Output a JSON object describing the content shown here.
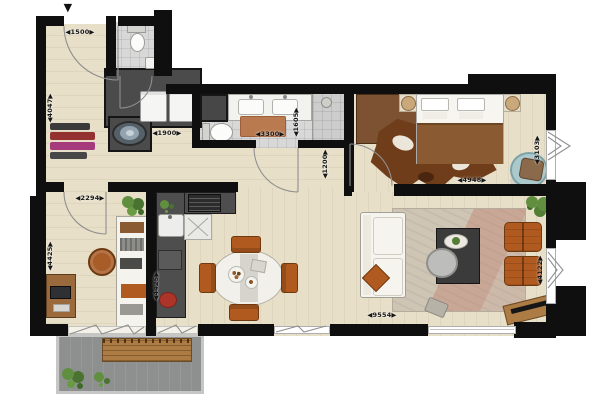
{
  "plan": {
    "title": "apartment-floor-plan",
    "entrance_marker": "▼",
    "dimensions": {
      "entry_width": "◀1500▶",
      "hall_depth": "◀4047▶",
      "utility_width": "◀1900▶",
      "bathroom_width": "◀3300▶",
      "bathroom_depth": "◀1605▶",
      "corridor_width": "◀1200▶",
      "bedroom_width": "◀4948▶",
      "bedroom_depth": "◀3103▶",
      "study_width": "◀2294▶",
      "study_depth": "◀4425▶",
      "kitchen_run": "◀4425▶",
      "living_width": "◀9554▶",
      "living_depth": "◀4122▶"
    },
    "colors": {
      "wall": "#0f0f0f",
      "wood_floor": "#e8dfc9",
      "tile_floor": "#d8d8d8",
      "dark_unit": "#4b4b4b",
      "balcony_floor": "#8e908f",
      "wood_furniture": "#ad7c44",
      "orange_accent": "#b05a20",
      "bed_blanket": "#8a5a33",
      "rug": "#cfc5b5",
      "plant_green": "#5f8f3f",
      "teal_chair": "#abc8cb",
      "white_furniture": "#f6f4ef"
    },
    "furniture_icons": [
      "bed-icon",
      "wardrobe-icon",
      "cowhide-rug-icon",
      "lamp-icon",
      "lounge-chair-icon",
      "sofa-icon",
      "coffee-table-icon",
      "armchair-icon",
      "tv-sideboard-icon",
      "dining-table-icon",
      "dining-chair-icon",
      "kitchen-counter-icon",
      "stove-icon",
      "sink-icon",
      "toilet-icon",
      "washbasin-icon",
      "vanity-icon",
      "shower-drain-icon",
      "washing-machine-icon",
      "laundry-basin-icon",
      "desk-icon",
      "office-chair-icon",
      "shelf-unit-icon",
      "coat-rack-icon",
      "plant-icon",
      "bench-icon"
    ]
  }
}
